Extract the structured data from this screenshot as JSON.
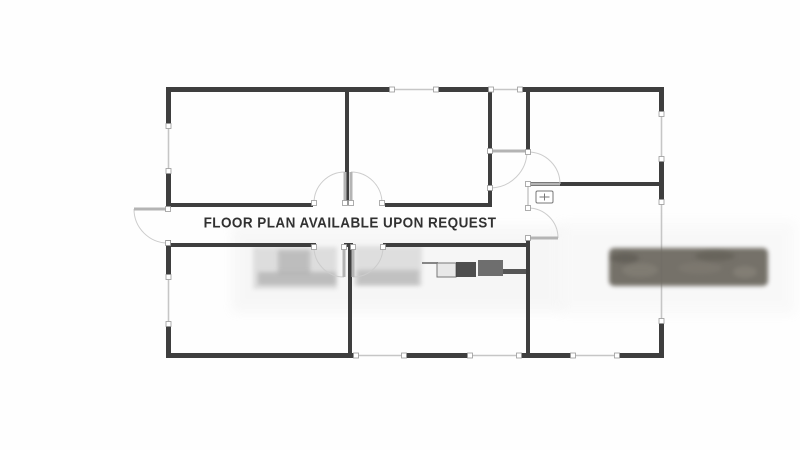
{
  "watermark": {
    "text": "FLOOR PLAN AVAILABLE UPON REQUEST"
  },
  "floorplan": {
    "colors": {
      "wall": "#3e3e3e",
      "window_line": "#c6c6c6",
      "door_leaf": "#b4b4b4",
      "arc": "#cccccc",
      "cap_fill": "#ffffff",
      "cap_stroke": "#999999",
      "panel_stroke": "#777777",
      "dark_furniture": "#6e6a62",
      "watermark_text": "#313131"
    },
    "walls": [
      [
        166,
        87,
        226,
        5
      ],
      [
        436,
        87,
        55,
        5
      ],
      [
        520,
        87,
        144,
        5
      ],
      [
        166,
        87,
        5,
        39
      ],
      [
        166,
        171,
        5,
        37
      ],
      [
        166,
        240,
        5,
        37
      ],
      [
        166,
        324,
        5,
        34
      ],
      [
        166,
        353,
        190,
        5
      ],
      [
        404,
        353,
        66,
        5
      ],
      [
        519,
        353,
        54,
        5
      ],
      [
        617,
        353,
        47,
        5
      ],
      [
        659,
        87,
        5,
        27
      ],
      [
        659,
        159,
        5,
        43
      ],
      [
        659,
        321,
        5,
        37
      ],
      [
        345,
        89,
        4,
        116
      ],
      [
        488,
        89,
        4,
        118
      ],
      [
        526,
        89,
        4,
        62
      ],
      [
        526,
        238,
        4,
        120
      ],
      [
        348,
        245,
        4,
        112
      ],
      [
        344,
        243,
        9,
        4
      ],
      [
        166,
        203,
        147,
        4
      ],
      [
        385,
        203,
        105,
        4
      ],
      [
        166,
        243,
        150,
        4
      ],
      [
        383,
        243,
        145,
        4
      ],
      [
        526,
        182,
        138,
        4
      ]
    ],
    "windows": [
      [
        392,
        89.5,
        436,
        89.5
      ],
      [
        491,
        89.5,
        520,
        89.5
      ],
      [
        168.5,
        126,
        168.5,
        171
      ],
      [
        168.5,
        277,
        168.5,
        324
      ],
      [
        356,
        355.5,
        404,
        355.5
      ],
      [
        470,
        355.5,
        519,
        355.5
      ],
      [
        573,
        355.5,
        617,
        355.5
      ],
      [
        661.5,
        114,
        661.5,
        159
      ],
      [
        661.5,
        202,
        661.5,
        321
      ]
    ],
    "thin_lines": [
      {
        "x1": 528,
        "y1": 186,
        "x2": 528,
        "y2": 206
      }
    ],
    "doors": [
      {
        "name": "front-entry-door",
        "hinge": [
          168,
          209
        ],
        "tip": [
          134,
          209
        ],
        "closed": [
          168,
          243
        ],
        "sweep": 1
      },
      {
        "name": "hall-to-top-left-room-door",
        "hinge": [
          345,
          203
        ],
        "tip": [
          345,
          172
        ],
        "closed": [
          314,
          203
        ],
        "sweep": 1
      },
      {
        "name": "hall-to-top-middle-room-door",
        "hinge": [
          351,
          203
        ],
        "tip": [
          351,
          172
        ],
        "closed": [
          382,
          203
        ],
        "sweep": 0
      },
      {
        "name": "hall-to-bottom-left-room-door",
        "hinge": [
          344,
          247
        ],
        "tip": [
          344,
          277
        ],
        "closed": [
          314,
          247
        ],
        "sweep": 0
      },
      {
        "name": "hall-to-kitchen-door",
        "hinge": [
          353,
          247
        ],
        "tip": [
          353,
          277
        ],
        "closed": [
          383,
          247
        ],
        "sweep": 1
      },
      {
        "name": "closet-door",
        "hinge": [
          490,
          151
        ],
        "tip": [
          527,
          151
        ],
        "closed": [
          490,
          188
        ],
        "sweep": 0
      },
      {
        "name": "top-right-room-door",
        "hinge": [
          528,
          184
        ],
        "tip": [
          560,
          184
        ],
        "closed": [
          528,
          152
        ],
        "sweep": 1
      },
      {
        "name": "right-room-door",
        "hinge": [
          528,
          238
        ],
        "tip": [
          558,
          238
        ],
        "closed": [
          528,
          208
        ],
        "sweep": 1
      }
    ],
    "ghosts": [
      {
        "name": "faded-photo-band",
        "shape": "rect",
        "x": 232,
        "y": 226,
        "w": 330,
        "h": 86,
        "fill": "#b9b9b9",
        "opacity": 0.1,
        "filter": "f2"
      },
      {
        "name": "faded-photo-band",
        "shape": "rect",
        "x": 560,
        "y": 222,
        "w": 235,
        "h": 92,
        "fill": "#c0c0c0",
        "opacity": 0.08,
        "filter": "f2"
      },
      {
        "name": "faded-bed",
        "shape": "rect",
        "x": 253,
        "y": 247,
        "w": 84,
        "h": 42,
        "fill": "#b0b0b0",
        "opacity": 0.35,
        "filter": "f1"
      },
      {
        "name": "faded-bed-pillows",
        "shape": "rect",
        "x": 278,
        "y": 250,
        "w": 32,
        "h": 24,
        "fill": "#8f8f8f",
        "opacity": 0.4,
        "filter": "f1"
      },
      {
        "name": "faded-bed-base",
        "shape": "rect",
        "x": 258,
        "y": 272,
        "w": 78,
        "h": 13,
        "fill": "#9c9c9c",
        "opacity": 0.5,
        "filter": "f1"
      },
      {
        "name": "faded-kitchen-cabinet",
        "shape": "rect",
        "x": 354,
        "y": 246,
        "w": 68,
        "h": 40,
        "fill": "#b4b4b4",
        "opacity": 0.35,
        "filter": "f1"
      },
      {
        "name": "faded-kitchen-cabinet-base",
        "shape": "rect",
        "x": 357,
        "y": 270,
        "w": 62,
        "h": 15,
        "fill": "#a0a0a0",
        "opacity": 0.45,
        "filter": "f1"
      },
      {
        "name": "kitchen-counter-line",
        "shape": "rect",
        "x": 422,
        "y": 262,
        "w": 16,
        "h": 2,
        "fill": "#6a6a6a",
        "opacity": 0.8
      },
      {
        "name": "kitchen-sink",
        "shape": "rect",
        "x": 437,
        "y": 263,
        "w": 19,
        "h": 14,
        "fill": "#e8e8e8",
        "opacity": 1,
        "stroke": "#777777"
      },
      {
        "name": "kitchen-stove",
        "shape": "rect",
        "x": 456,
        "y": 262,
        "w": 20,
        "h": 15,
        "fill": "#3c3c3c",
        "opacity": 0.9
      },
      {
        "name": "kitchen-appliance",
        "shape": "rect",
        "x": 478,
        "y": 260,
        "w": 25,
        "h": 16,
        "fill": "#565656",
        "opacity": 0.85
      },
      {
        "name": "kitchen-counter-bar",
        "shape": "rect",
        "x": 503,
        "y": 269,
        "w": 25,
        "h": 5,
        "fill": "#454545",
        "opacity": 0.9
      }
    ],
    "dark_bar": {
      "name": "dark-furniture-bar",
      "x": 609,
      "y": 248,
      "w": 159,
      "h": 38,
      "rx": 5,
      "fill": "#6e6a62",
      "opacity": 0.95,
      "mottles": [
        {
          "cx": 640,
          "cy": 270,
          "rx": 18,
          "ry": 7,
          "fill": "#8a867c",
          "opacity": 0.5
        },
        {
          "cx": 700,
          "cy": 268,
          "rx": 22,
          "ry": 6,
          "fill": "#847f76",
          "opacity": 0.45
        },
        {
          "cx": 745,
          "cy": 272,
          "rx": 12,
          "ry": 6,
          "fill": "#8f8a80",
          "opacity": 0.5
        },
        {
          "cx": 625,
          "cy": 258,
          "rx": 14,
          "ry": 5,
          "fill": "#5a564f",
          "opacity": 0.6
        },
        {
          "cx": 715,
          "cy": 256,
          "rx": 20,
          "ry": 5,
          "fill": "#5c5850",
          "opacity": 0.5
        }
      ]
    },
    "panel": {
      "x": 536,
      "y": 191,
      "w": 17,
      "h": 12
    }
  }
}
